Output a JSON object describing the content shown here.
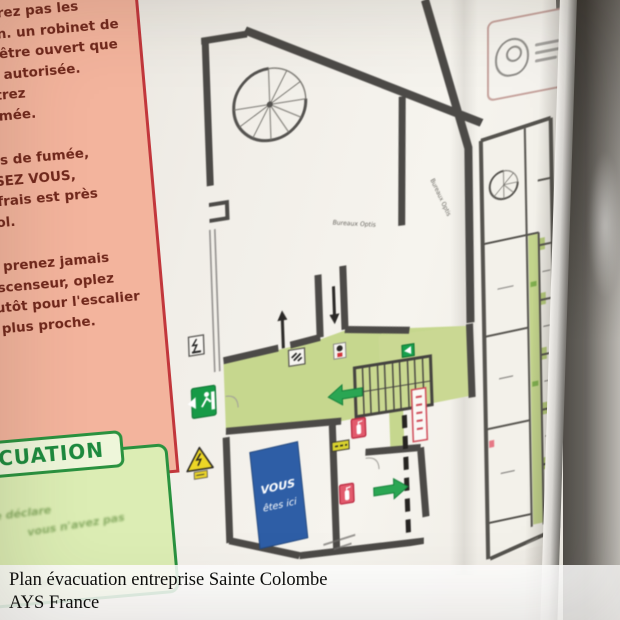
{
  "caption": {
    "line1": "Plan évacuation entreprise Sainte Colombe",
    "line2": "AYS France"
  },
  "instructions_panel": {
    "marker": "✱",
    "para1": {
      "l1": "combrez pas les",
      "l2": "uation.  un robinet de",
      "l3": "peut être ouvert que",
      "l4": "onne autorisée. n'entrez",
      "l5": "la fumée."
    },
    "para2": {
      "l1": "n cas de fumée,",
      "l2": "AISSEZ VOUS,",
      "l3": "air frais est près",
      "l4": "u sol."
    },
    "para3": {
      "l1": "Ne prenez jamais",
      "l2": "l'ascenseur, oplez",
      "l3": "plutôt pour l'escalier",
      "l4": "le plus proche."
    }
  },
  "evacuation_box": {
    "tab": "ACUATION",
    "frag1": "se déclare",
    "frag2": "vous n'avez pas",
    "frag3": "ment en"
  },
  "floor_plan": {
    "label_bureaux_1": "Bureaux Optis",
    "label_bureaux_2": "Bureaux Optis",
    "you_are_here_1": "VOUS",
    "you_are_here_2": "êtes ici",
    "icons": [
      "spiral-staircase",
      "straight-staircase",
      "exit-sign",
      "exit-arrow",
      "fire-extinguisher",
      "electrical-hazard-triangle",
      "electrical-panel-sign",
      "emergency-light",
      "hose-reel-sign",
      "flow-arrow-up",
      "flow-arrow-down",
      "you-are-here"
    ],
    "colors": {
      "wall": "#4c4a47",
      "corridor_green": "#c6d78e",
      "exit_green": "#169a46",
      "extinguisher_red": "#e25a6c",
      "warning_yellow": "#ecd626",
      "you_are_here_blue": "#2e5ea6",
      "panel_pink": "#f3b49d",
      "box_green_border": "#2a923f"
    }
  }
}
